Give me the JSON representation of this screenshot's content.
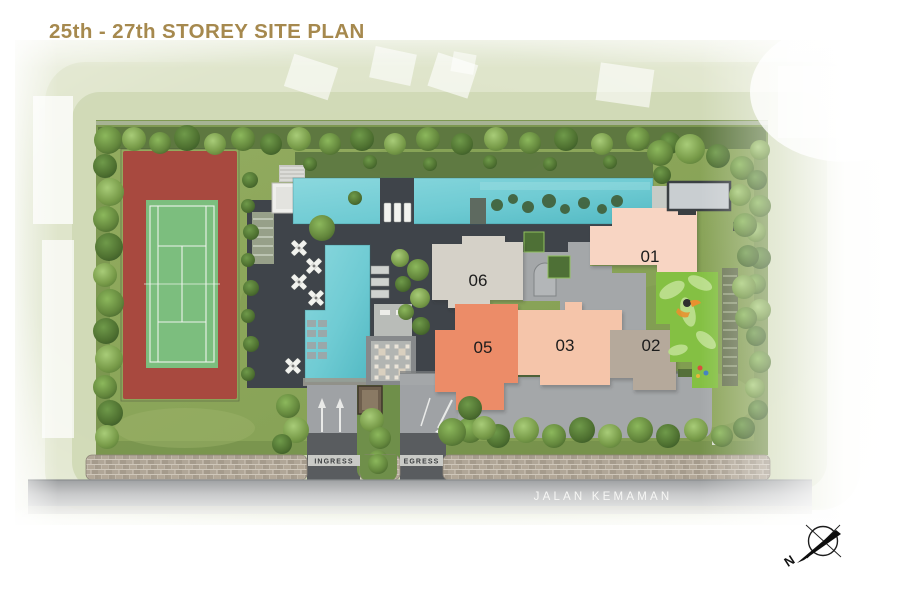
{
  "page": {
    "title": "25th - 27th STOREY SITE PLAN",
    "title_color": "#A6894E"
  },
  "site": {
    "street_name": "JALAN KEMAMAN",
    "ingress_label": "INGRESS",
    "egress_label": "EGRESS",
    "compass": {
      "label": "N",
      "icon": "compass-icon"
    },
    "blocks": [
      {
        "id": "01",
        "color": "#F8D5C3"
      },
      {
        "id": "02",
        "color": "#B5A99B"
      },
      {
        "id": "03",
        "color": "#F5C5AA"
      },
      {
        "id": "05",
        "color": "#EC8C67"
      },
      {
        "id": "06",
        "color": "#D5D1C8"
      }
    ],
    "features": {
      "tennis_court_color": "#A8493F",
      "court_surface_color": "#7CBE7E",
      "pool_color": "#6FCBD3",
      "deck_color": "#3F444A",
      "landscape_color": "#8CA65C",
      "playground_color": "#84C043",
      "core_color": "#A4A7A9"
    }
  }
}
